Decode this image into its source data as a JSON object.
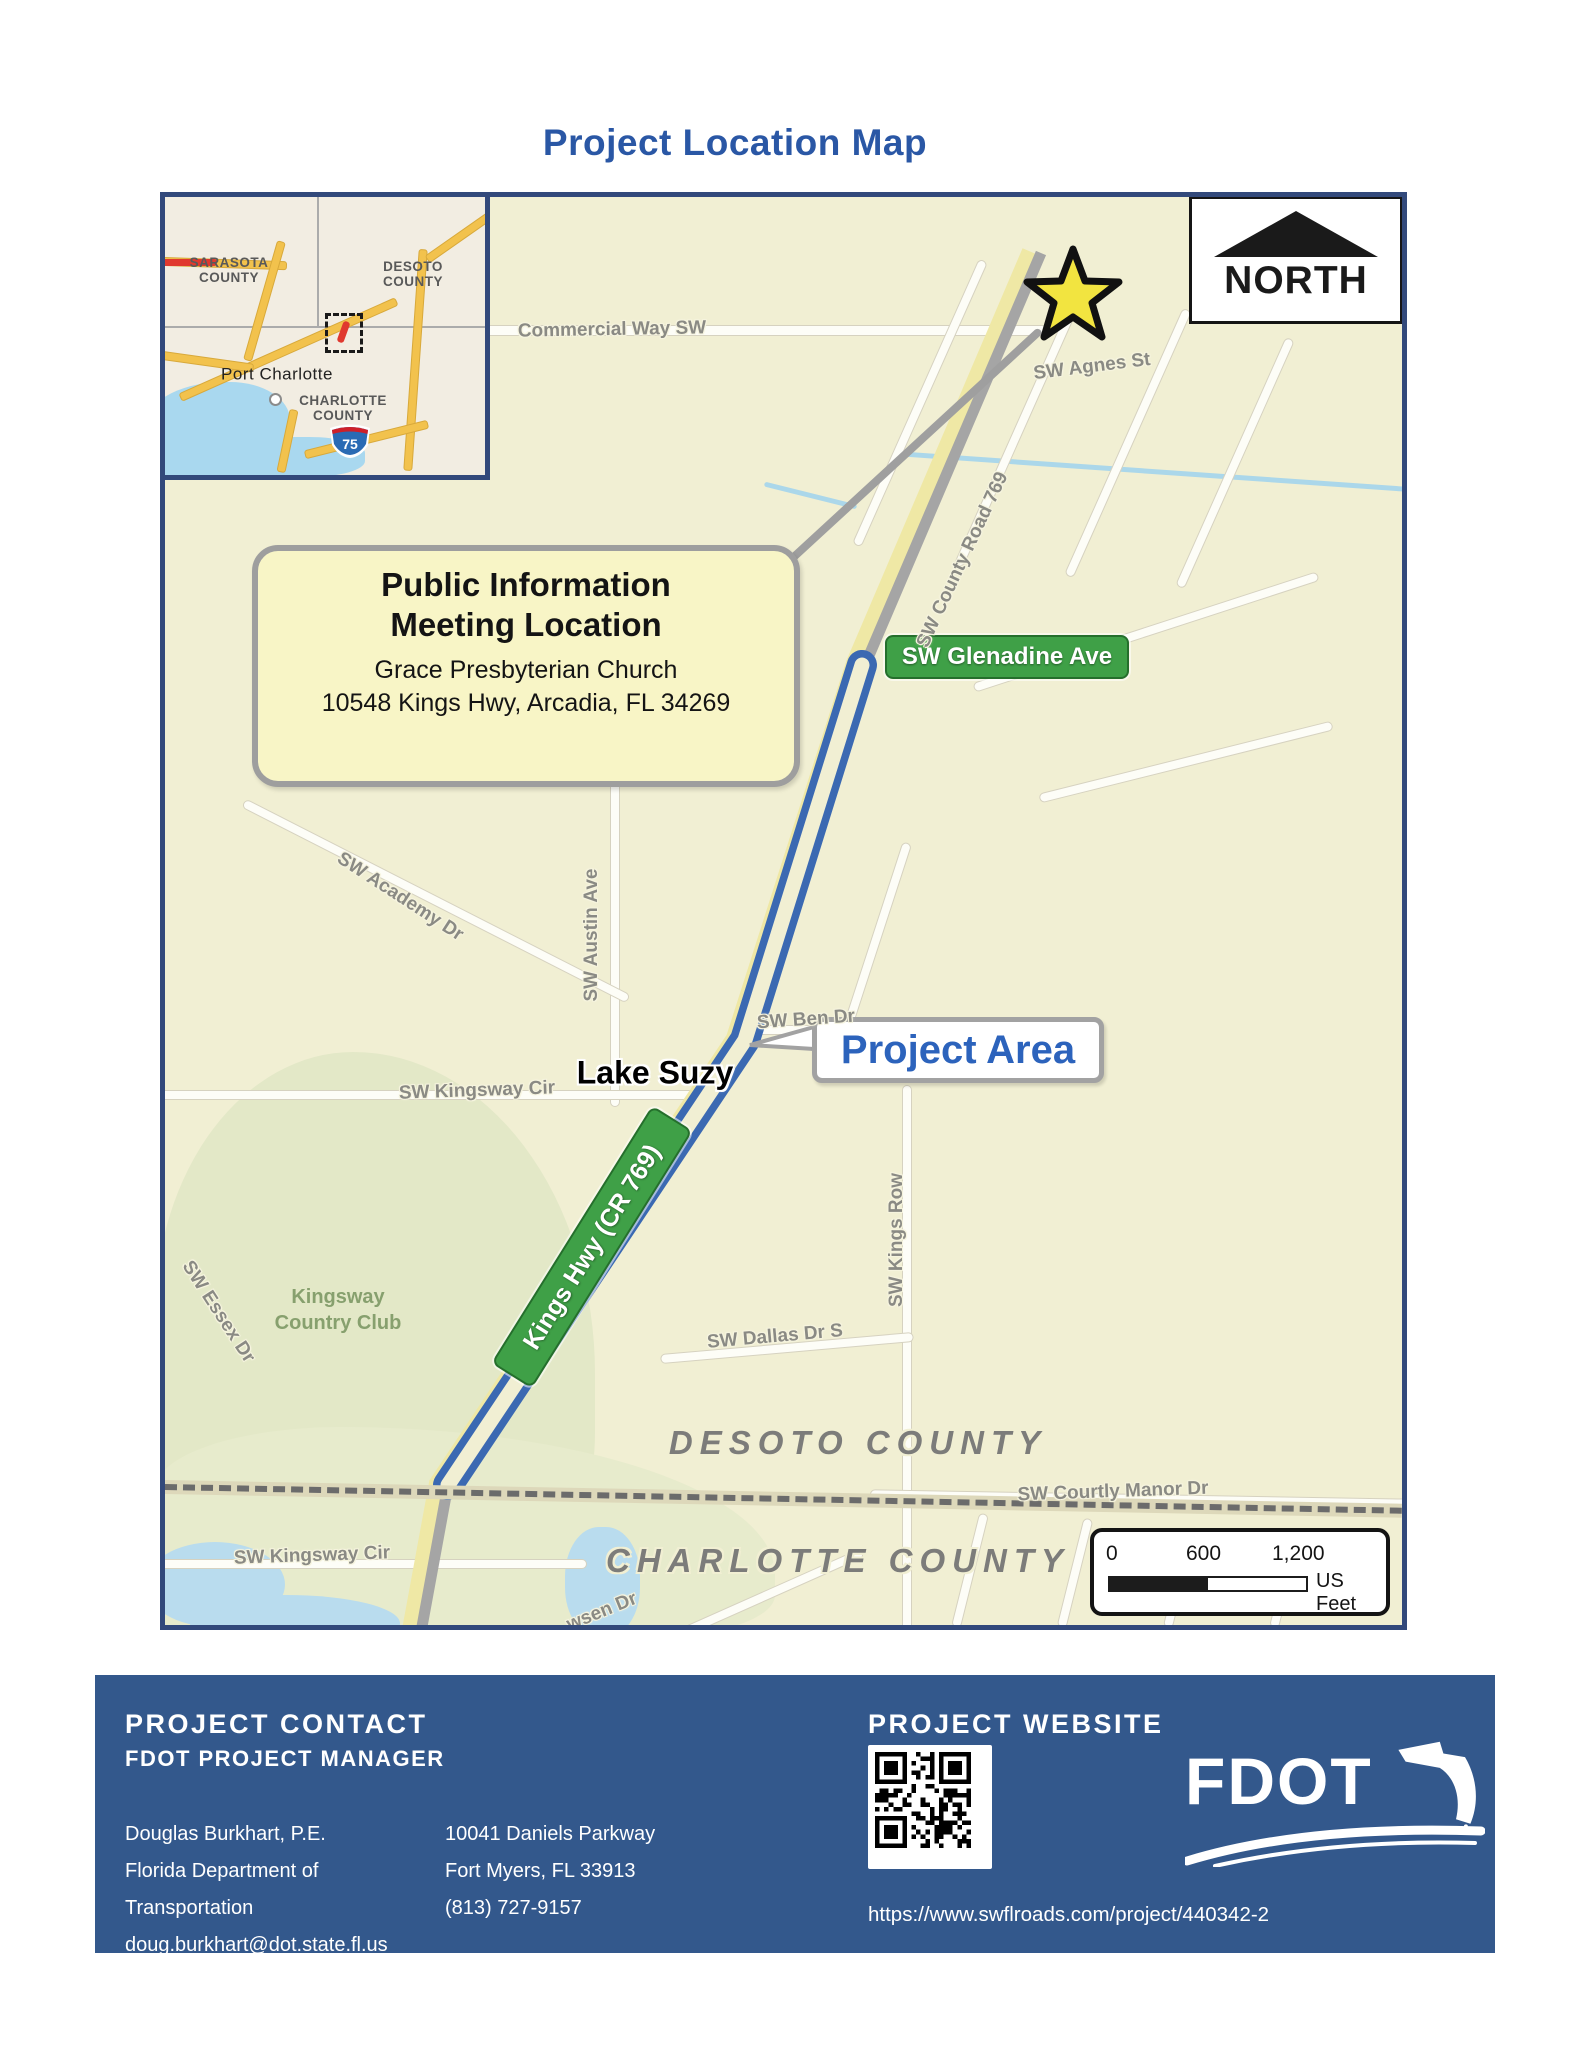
{
  "title": "Project Location Map",
  "map": {
    "north_label": "NORTH",
    "inset": {
      "sarasota_l1": "SARASOTA",
      "sarasota_l2": "COUNTY",
      "desoto_l1": "DESOTO",
      "desoto_l2": "COUNTY",
      "port_charlotte": "Port Charlotte",
      "charlotte_l1": "CHARLOTTE",
      "charlotte_l2": "COUNTY",
      "interstate": "75"
    },
    "callout": {
      "title_l1": "Public Information",
      "title_l2": "Meeting Location",
      "venue": "Grace Presbyterian Church",
      "address": "10548 Kings Hwy, Arcadia, FL 34269"
    },
    "signs": {
      "glenadine": "SW Glenadine Ave",
      "kings_hwy": "Kings Hwy (CR 769)"
    },
    "project_area": "Project Area",
    "places": {
      "lake_suzy": "Lake Suzy",
      "club_l1": "Kingsway",
      "club_l2": "Country Club"
    },
    "roads": {
      "commercial": "Commercial Way SW",
      "agnes": "SW Agnes St",
      "county_road": "SW County Road 769",
      "academy": "SW Academy Dr",
      "austin": "SW Austin Ave",
      "kingsway_cir_upper": "SW Kingsway Cir",
      "ben": "SW Ben Dr",
      "kings_row": "SW Kings Row",
      "dallas": "SW Dallas Dr S",
      "essex": "SW Essex Dr",
      "courtly_manor": "SW Courtly Manor Dr",
      "kingsway_cir_lower": "SW Kingsway Cir",
      "wsen": "wsen Dr"
    },
    "counties": {
      "desoto": "DESOTO COUNTY",
      "charlotte": "CHARLOTTE COUNTY"
    },
    "scale": {
      "t0": "0",
      "t1": "600",
      "t2": "1,200",
      "unit": "US Feet"
    }
  },
  "footer": {
    "contact_heading": "PROJECT CONTACT",
    "contact_subheading": "FDOT PROJECT MANAGER",
    "col1": [
      "Douglas Burkhart, P.E.",
      "Florida Department of Transportation",
      "doug.burkhart@dot.state.fl.us"
    ],
    "col2": [
      "10041 Daniels Parkway",
      "Fort Myers, FL 33913",
      "(813) 727-9157"
    ],
    "website_heading": "PROJECT WEBSITE",
    "website_url": "https://www.swflroads.com/project/440342-2",
    "logo_text": "FDOT"
  },
  "colors": {
    "title_blue": "#2A57A5",
    "footer_blue": "#33588C",
    "map_border": "#32497B",
    "sign_green": "#3FA047",
    "project_outline_blue": "#3B69B2",
    "project_label_blue": "#2C63BC",
    "star_yellow": "#F2E440",
    "map_background": "#F1EFD3"
  }
}
